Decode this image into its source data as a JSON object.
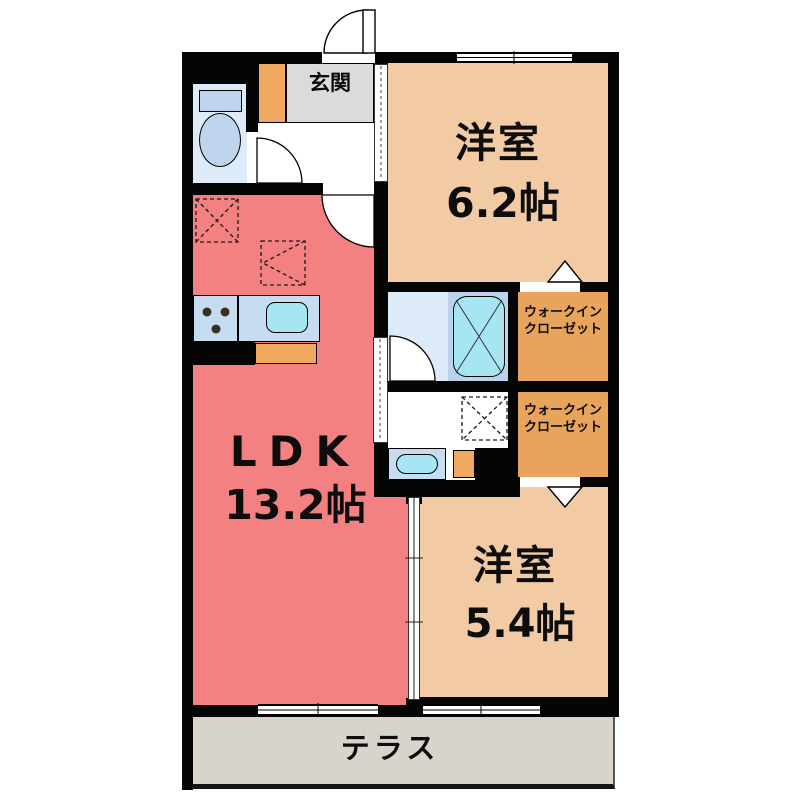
{
  "floorplan": {
    "labels": {
      "genkan": "玄関",
      "bedroom1_name": "洋室",
      "bedroom1_size": "6.2帖",
      "ldk_name": "LDK",
      "ldk_size": "13.2帖",
      "bedroom2_name": "洋室",
      "bedroom2_size": "5.4帖",
      "wic1": {
        "line1": "ウォークイン",
        "line2": "クローゼット"
      },
      "wic2": {
        "line1": "ウォークイン",
        "line2": "クローゼット"
      },
      "terrace": "テラス"
    },
    "colors": {
      "wall": "#050505",
      "ldk": "#F48181",
      "bedroom": "#F2CBA5",
      "wic": "#E8A35D",
      "cabinet": "#F0A95E",
      "genkan": "#DBDBDB",
      "terrace": "#D9D4CB",
      "waterroom": "#DDEAF8",
      "fixture": "#BFD5EE",
      "counter": "#C6DCF1",
      "cyan": "#A6E6F2",
      "bathpanel": "#BAD4EE"
    }
  }
}
